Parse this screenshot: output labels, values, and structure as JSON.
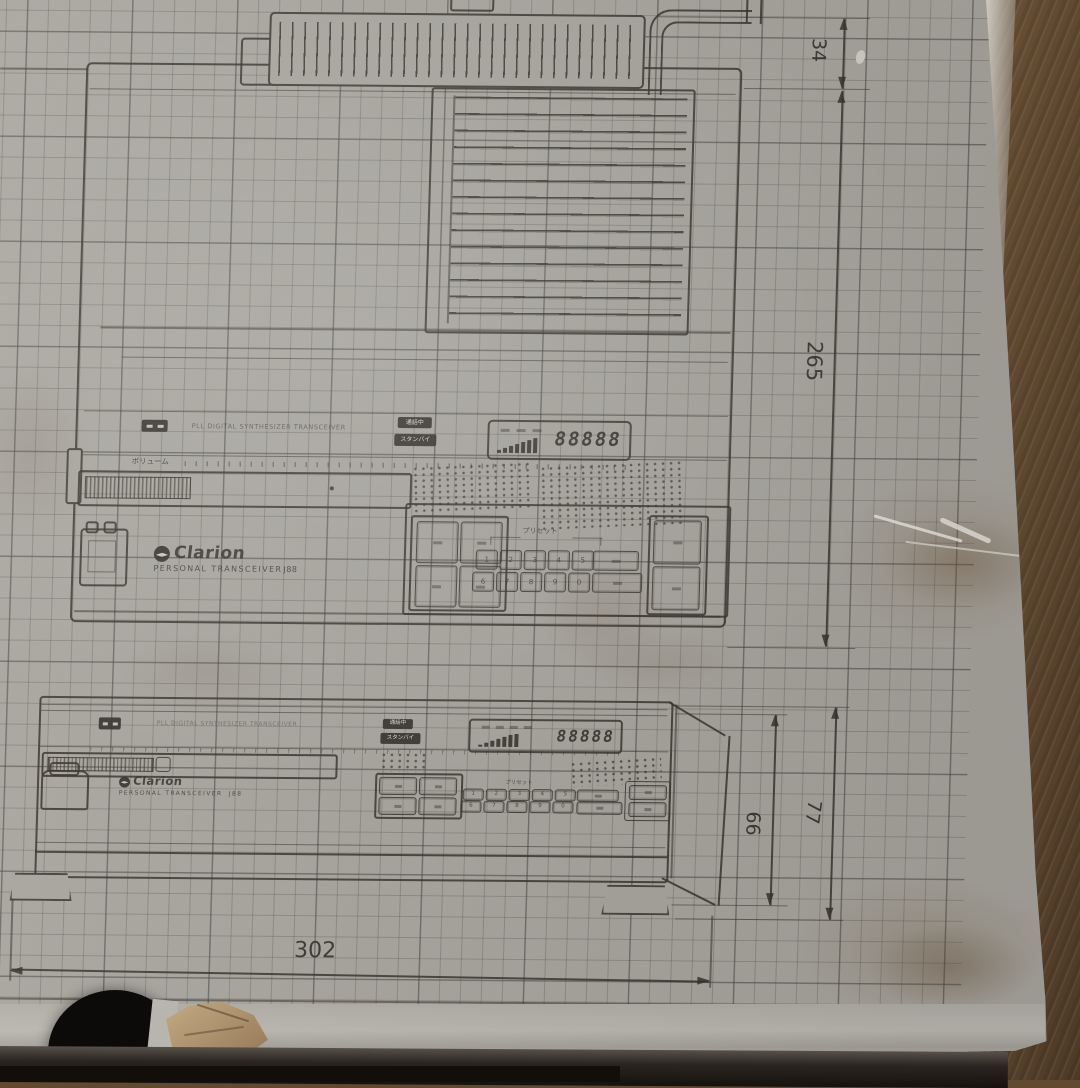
{
  "colors": {
    "paper": "#a9a69f",
    "grid_line": "#7d7a72",
    "ink": "#37332c",
    "wood": "#5f4931",
    "hole": "#0d0b09",
    "cardboard_tear": "#b39a74"
  },
  "drawing": {
    "brand": "Clarion",
    "product": "PERSONAL TRANSCEIVER",
    "model": "J88",
    "subtitle": "PLL DIGITAL SYNTHESIZER TRANSCEIVER",
    "volume_label": "ボリューム",
    "preset_label": "プリセット",
    "status_badge_top": "通話中",
    "status_badge_bottom": "スタンバイ",
    "lcd_digits": "88888",
    "preset_keys_row1": [
      "1",
      "2",
      "3",
      "4",
      "5"
    ],
    "preset_keys_row2": [
      "6",
      "7",
      "8",
      "9",
      "0"
    ],
    "dimensions": {
      "rear_section_height_mm": "34",
      "depth_mm": "265",
      "width_mm": "302",
      "front_body_height_mm": "66",
      "front_total_height_mm": "77"
    }
  }
}
